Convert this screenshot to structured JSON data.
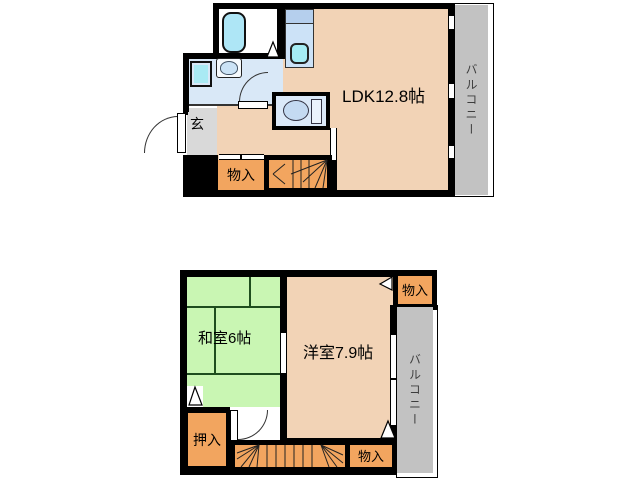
{
  "upper_floor": {
    "ldk_label": "LDK12.8帖",
    "entrance_label": "玄",
    "storage_label": "物入",
    "balcony_label": "バルコニー"
  },
  "lower_floor": {
    "japanese_room_label": "和室6帖",
    "western_room_label": "洋室7.9帖",
    "storage_upper_label": "物入",
    "storage_lower_label": "物入",
    "closet_label": "押入",
    "balcony_label": "バルコニー"
  },
  "colors": {
    "room_peach": "#F2D3B6",
    "tatami_green": "#C9F6B3",
    "storage_orange": "#F2A55F",
    "balcony_gray": "#C2C2C2",
    "entrance_gray": "#D9D9D9",
    "wet_area_blue": "#D9E8F7",
    "fixture_cyan": "#A9E9F2",
    "wall_black": "#000000"
  }
}
